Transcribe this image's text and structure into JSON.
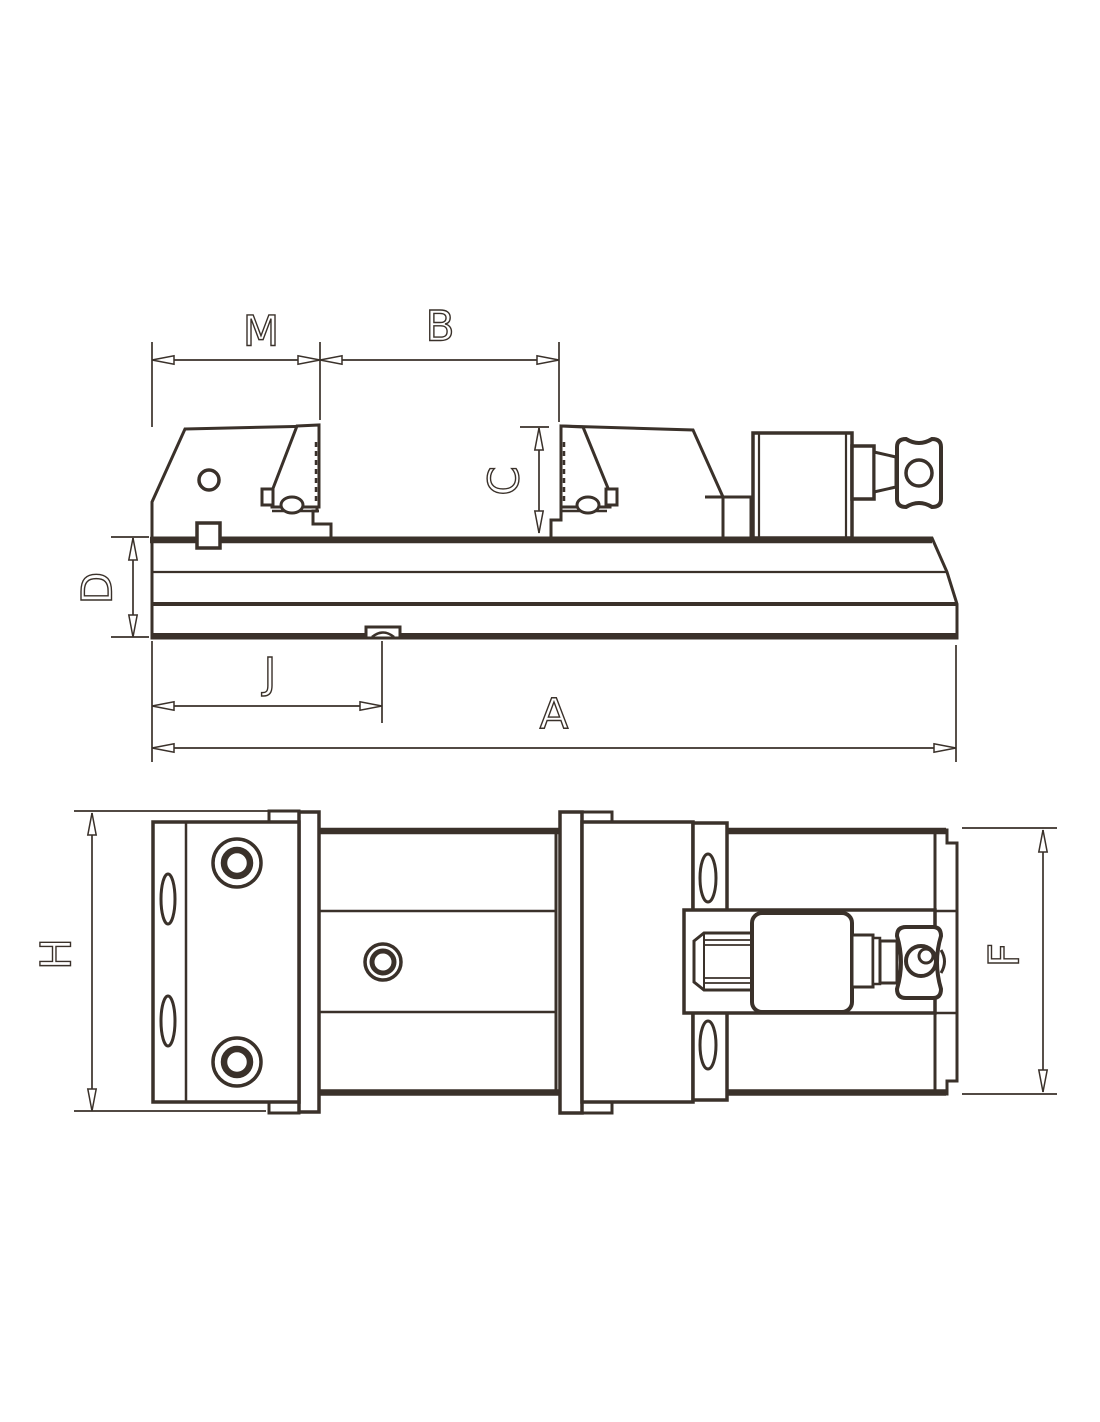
{
  "drawing": {
    "type": "engineering technical drawing",
    "subject": "precision machine vise, two orthographic views",
    "ink_color": "#3a312a",
    "background_color": "#ffffff"
  },
  "labels": {
    "M": "M",
    "B": "B",
    "C": "C",
    "D": "D",
    "J": "J",
    "A": "A",
    "H": "H",
    "F": "F"
  },
  "views": {
    "elevation": {
      "name": "side elevation view",
      "dimension_ids": [
        "M",
        "B",
        "C",
        "D",
        "J",
        "A"
      ]
    },
    "plan": {
      "name": "top plan view",
      "dimension_ids": [
        "H",
        "F"
      ]
    }
  }
}
